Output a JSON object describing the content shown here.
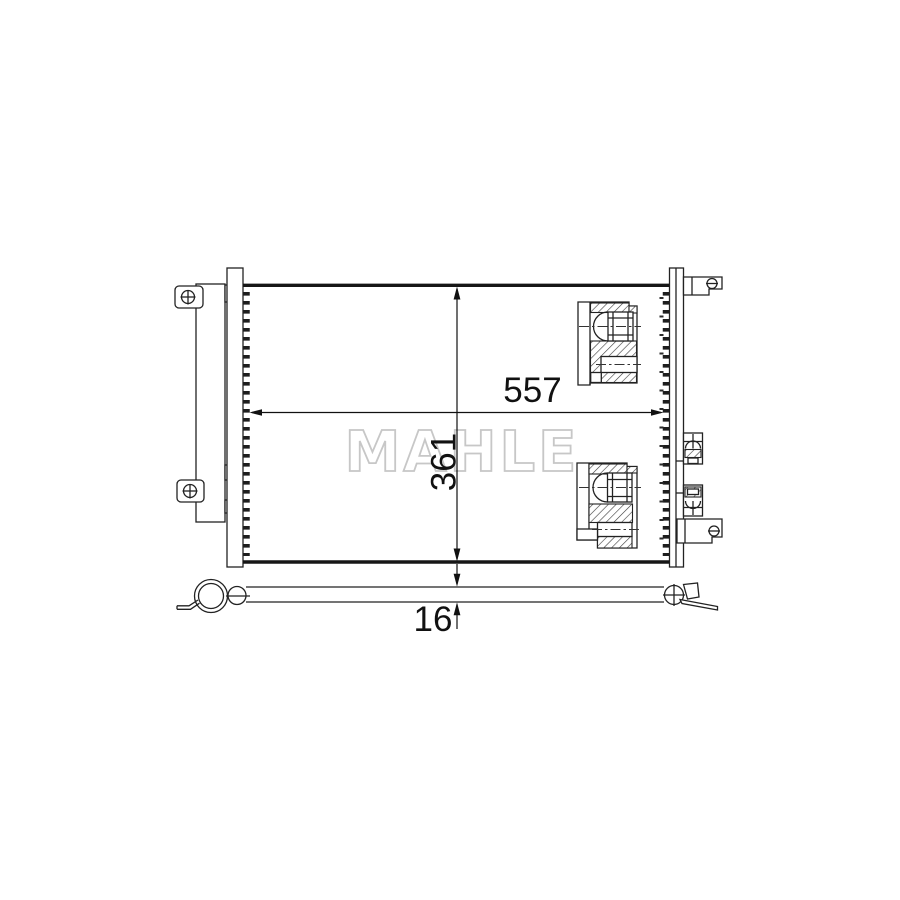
{
  "page": {
    "background_color": "#ffffff"
  },
  "drawing": {
    "watermark_text": "MAHLE",
    "line_color": "#222222",
    "watermark_color": "#c7c7c7",
    "dimensions": {
      "width": "557",
      "height": "361",
      "thickness": "16"
    }
  }
}
